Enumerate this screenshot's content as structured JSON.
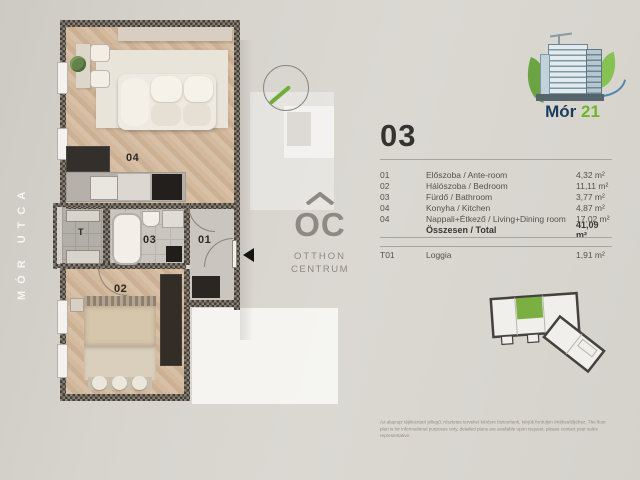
{
  "floorplan": {
    "street_label": "MÓR UTCA",
    "labels": {
      "living_kitchen": "04",
      "bathroom": "03",
      "ante_room": "01",
      "bedroom": "02",
      "loggia": "T"
    }
  },
  "watermark": {
    "initials": "OC",
    "line1": "OTTHON",
    "line2": "CENTRUM"
  },
  "brand": {
    "name": "Mór",
    "number": "21"
  },
  "unit": {
    "title": "03",
    "rows": [
      {
        "num": "01",
        "name": "Előszoba / Ante-room",
        "area": "4,32 m²"
      },
      {
        "num": "02",
        "name": "Hálószoba / Bedroom",
        "area": "11,11 m²"
      },
      {
        "num": "03",
        "name": "Fürdő / Bathroom",
        "area": "3,77 m²"
      },
      {
        "num": "04",
        "name": "Konyha / Kitchen",
        "area": "4,87 m²"
      },
      {
        "num": "04",
        "name": "Nappali+Étkező / Living+Dining room",
        "area": "17,02 m²"
      }
    ],
    "total_label": "Összesen / Total",
    "total_area": "41,09 m²",
    "extra_row": {
      "num": "T01",
      "name": "Loggia",
      "area": "1,91 m²"
    }
  },
  "disclaimer": {
    "hu": "Az alaprajz tájékoztató jellegű, részletes terveket kérésre biztosítunk, kérjük forduljon értékesítőjéhez.",
    "en": "The floor plan is for informational purposes only, detailed plans are available upon request, please contact your sales representative."
  },
  "colors": {
    "accent_green": "#76b82a",
    "brand_navy": "#1c3c5e",
    "wall_dark": "#413c36",
    "wood": "#d2b89f"
  }
}
